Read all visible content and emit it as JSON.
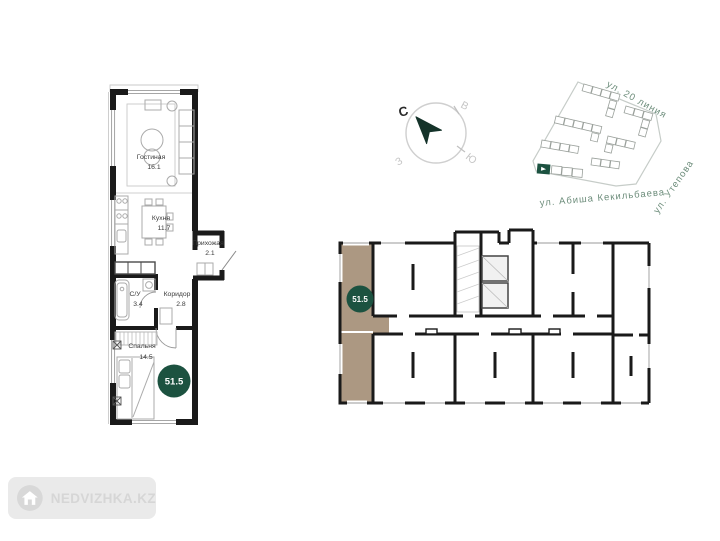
{
  "unit_plan": {
    "total_area": "51.5",
    "rooms": [
      {
        "name": "Гостиная",
        "area": "16.1"
      },
      {
        "name": "Кухня",
        "area": "11.7"
      },
      {
        "name": "Прихожая",
        "area": "2.1"
      },
      {
        "name": "С/У",
        "area": "3.4"
      },
      {
        "name": "Коридор",
        "area": "2.8"
      },
      {
        "name": "Спальня",
        "area": "14.5"
      }
    ]
  },
  "floor_plan": {
    "total_area": "51.5"
  },
  "compass": {
    "north": "С",
    "east": "В",
    "south": "Ю",
    "west": "З"
  },
  "site_plan": {
    "street_top": "ул. 20 линия",
    "street_right": "ул. Утепова",
    "street_bottom": "ул. Абиша Кекильбаева"
  },
  "watermark": {
    "text": "NEDVIZHKA.KZ"
  },
  "colors": {
    "accent_green": "#1c5240",
    "highlight_tan": "#ac9882",
    "street_label": "#6d8d7b",
    "wall": "#1a1a1a"
  }
}
